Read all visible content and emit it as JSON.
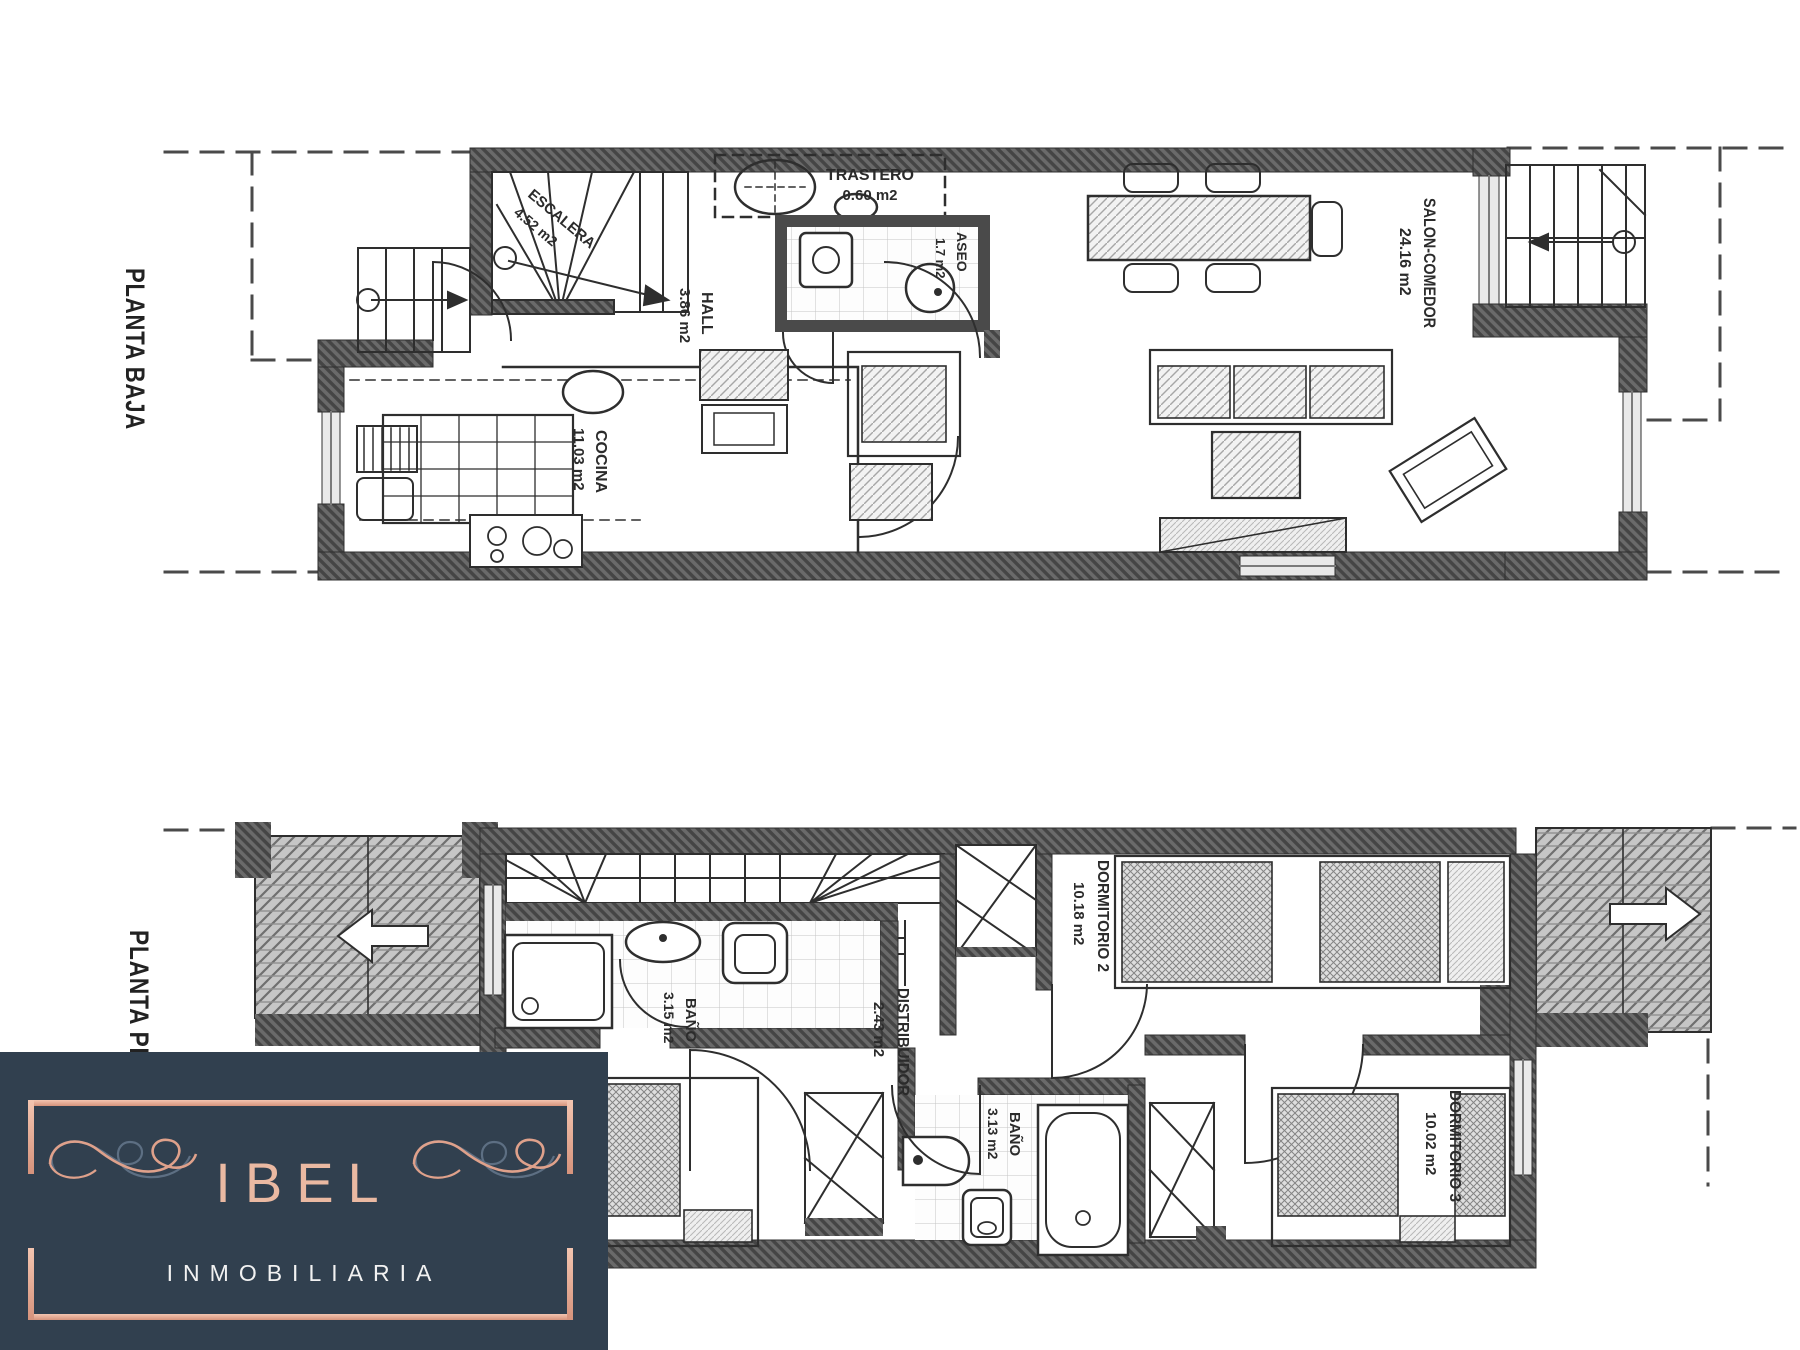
{
  "floors": {
    "baja": {
      "label": "PLANTA BAJA",
      "rooms": {
        "escalera": {
          "name": "ESCALERA",
          "area": "4.52 m2"
        },
        "trastero": {
          "name": "TRASTERO",
          "area": "0.60 m2"
        },
        "aseo": {
          "name": "ASEO",
          "area": "1.7 m2"
        },
        "hall": {
          "name": "HALL",
          "area": "3.86 m2"
        },
        "cocina": {
          "name": "COCINA",
          "area": "11.03 m2"
        },
        "salon": {
          "name": "SALON-COMEDOR",
          "area": "24.16 m2"
        }
      }
    },
    "primera": {
      "label": "PLANTA PRIMERA",
      "rooms": {
        "bano1": {
          "name": "BAÑO",
          "area": "3.15 m2"
        },
        "distribuidor": {
          "name": "DISTRIBUIDOR",
          "area": "2.43 m2"
        },
        "dormitorio2": {
          "name": "DORMITORIO 2",
          "area": "10.18 m2"
        },
        "bano2": {
          "name": "BAÑO",
          "area": "3.13 m2"
        },
        "dormitorio3": {
          "name": "DORMITORIO 3",
          "area": "10.02 m2"
        }
      }
    }
  },
  "logo": {
    "brand": "IBEL",
    "subtitle": "INMOBILIARIA"
  },
  "colors": {
    "logo_bg": "#31404f",
    "logo_accent": "#e5a78f",
    "logo_text": "#f2f2f2",
    "plan_ink": "#2b2b2b",
    "wall_gray": "#565656"
  }
}
